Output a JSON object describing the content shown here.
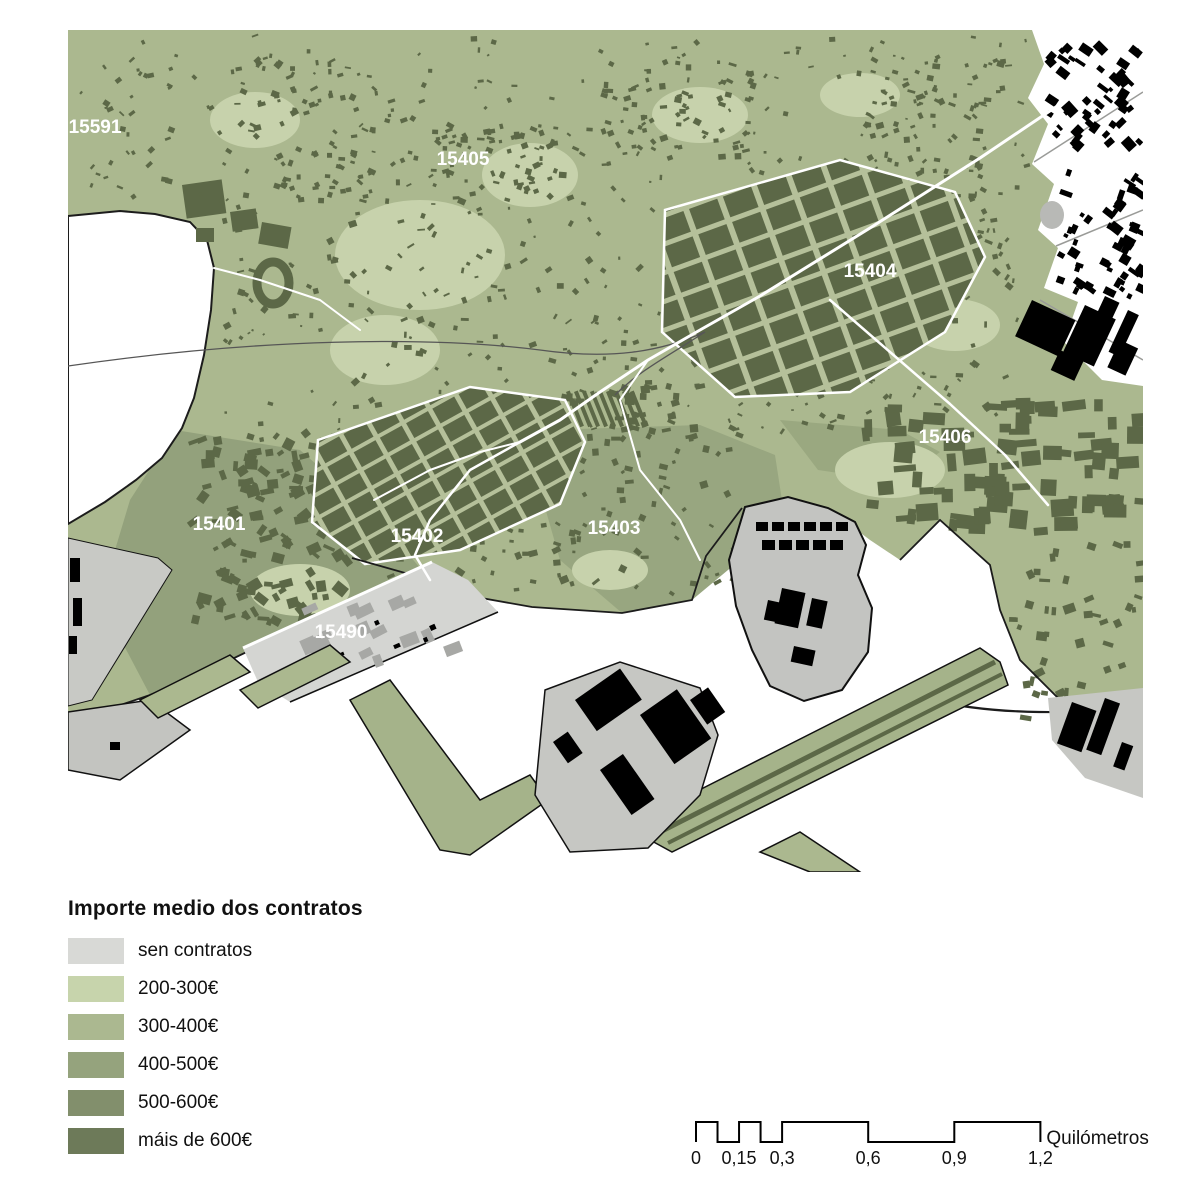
{
  "map": {
    "background": "#ffffff",
    "zone_label_color": "#ffffff",
    "zone_labels": [
      {
        "id": "15591",
        "x": 95,
        "y": 133
      },
      {
        "id": "15405",
        "x": 463,
        "y": 165
      },
      {
        "id": "15404",
        "x": 870,
        "y": 277
      },
      {
        "id": "15406",
        "x": 945,
        "y": 443
      },
      {
        "id": "15401",
        "x": 219,
        "y": 530
      },
      {
        "id": "15402",
        "x": 417,
        "y": 542
      },
      {
        "id": "15403",
        "x": 614,
        "y": 534
      },
      {
        "id": "15490",
        "x": 341,
        "y": 638
      }
    ]
  },
  "legend": {
    "title": "Importe medio dos contratos",
    "items": [
      {
        "label": "sen contratos",
        "color": "#d8d9d6"
      },
      {
        "label": "200-300€",
        "color": "#c7d4ac"
      },
      {
        "label": "300-400€",
        "color": "#abb890"
      },
      {
        "label": "400-500€",
        "color": "#95a37d"
      },
      {
        "label": "500-600€",
        "color": "#828f6c"
      },
      {
        "label": "máis de 600€",
        "color": "#6d7a59"
      }
    ]
  },
  "scalebar": {
    "unit_label": "Quilómetros",
    "ticks": [
      "0",
      "0,15",
      "0,3",
      "0,6",
      "0,9",
      "1,2"
    ],
    "tick_values": [
      0,
      0.15,
      0.3,
      0.6,
      0.9,
      1.2
    ]
  }
}
